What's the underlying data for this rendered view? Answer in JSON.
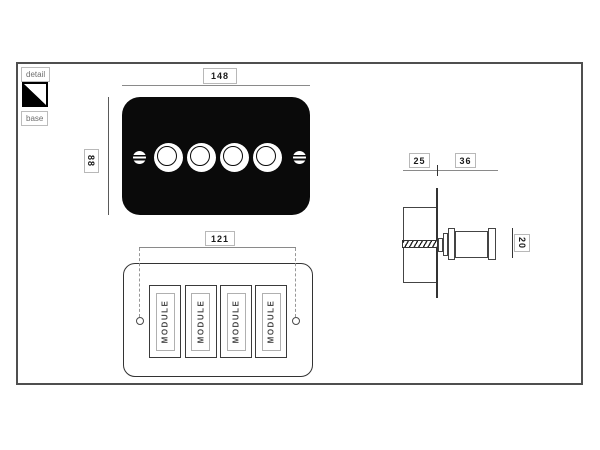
{
  "legend": {
    "detail": "detail",
    "base": "base"
  },
  "front_view": {
    "width_dim": "148",
    "height_dim": "88"
  },
  "rear_view": {
    "width_dim": "121",
    "modules": [
      {
        "label": "MODULE"
      },
      {
        "label": "MODULE"
      },
      {
        "label": "MODULE"
      },
      {
        "label": "MODULE"
      }
    ]
  },
  "side_view": {
    "box_depth_dim": "25",
    "projection_dim": "36",
    "knob_size_dim": "20"
  },
  "colors": {
    "plate_black": "#0a0a0a",
    "outline": "#3a3a3a",
    "dim_line": "#8a8a8a",
    "label_border": "#b8b8b8",
    "label_text": "#1a1a1a",
    "border": "#4f4f4f"
  }
}
